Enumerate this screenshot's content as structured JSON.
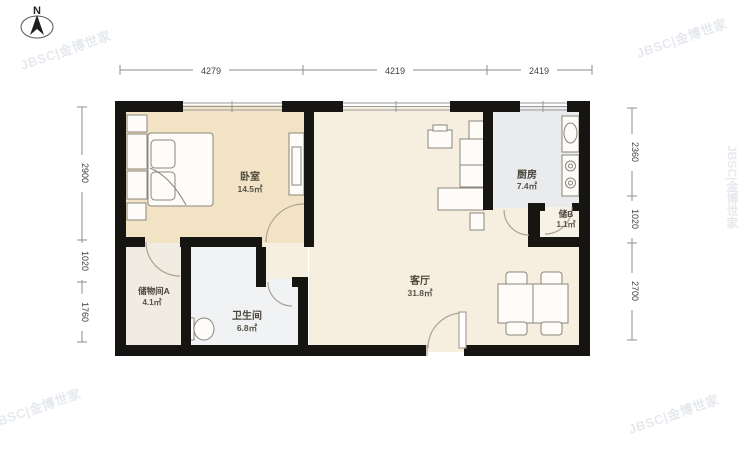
{
  "north": {
    "label": "N"
  },
  "watermark": {
    "text": "JBSC|金博世家"
  },
  "rooms": [
    {
      "id": "bedroom",
      "name": "卧室",
      "area": "14.5㎡"
    },
    {
      "id": "living",
      "name": "客厅",
      "area": "31.8㎡"
    },
    {
      "id": "kitchen",
      "name": "厨房",
      "area": "7.4㎡"
    },
    {
      "id": "bathroom",
      "name": "卫生间",
      "area": "6.8㎡"
    },
    {
      "id": "storage_a",
      "name": "储物间A",
      "area": "4.1㎡"
    },
    {
      "id": "storage_b",
      "name": "储B",
      "area": "1.1㎡"
    }
  ],
  "dimensions": {
    "top": [
      "4279",
      "4219",
      "2419"
    ],
    "left": [
      "2900",
      "1020",
      "1760"
    ],
    "right": [
      "2360",
      "1020",
      "2700"
    ]
  },
  "colors": {
    "bedroom_floor": "#f2e3c4",
    "living_floor": "#f6efe0",
    "kitchen_floor": "#e9ebed",
    "bathroom_floor": "#f1f2f4",
    "storage_a_floor": "#f1ece1",
    "storage_b_floor": "#f7f2e6",
    "wall": "#171512"
  }
}
